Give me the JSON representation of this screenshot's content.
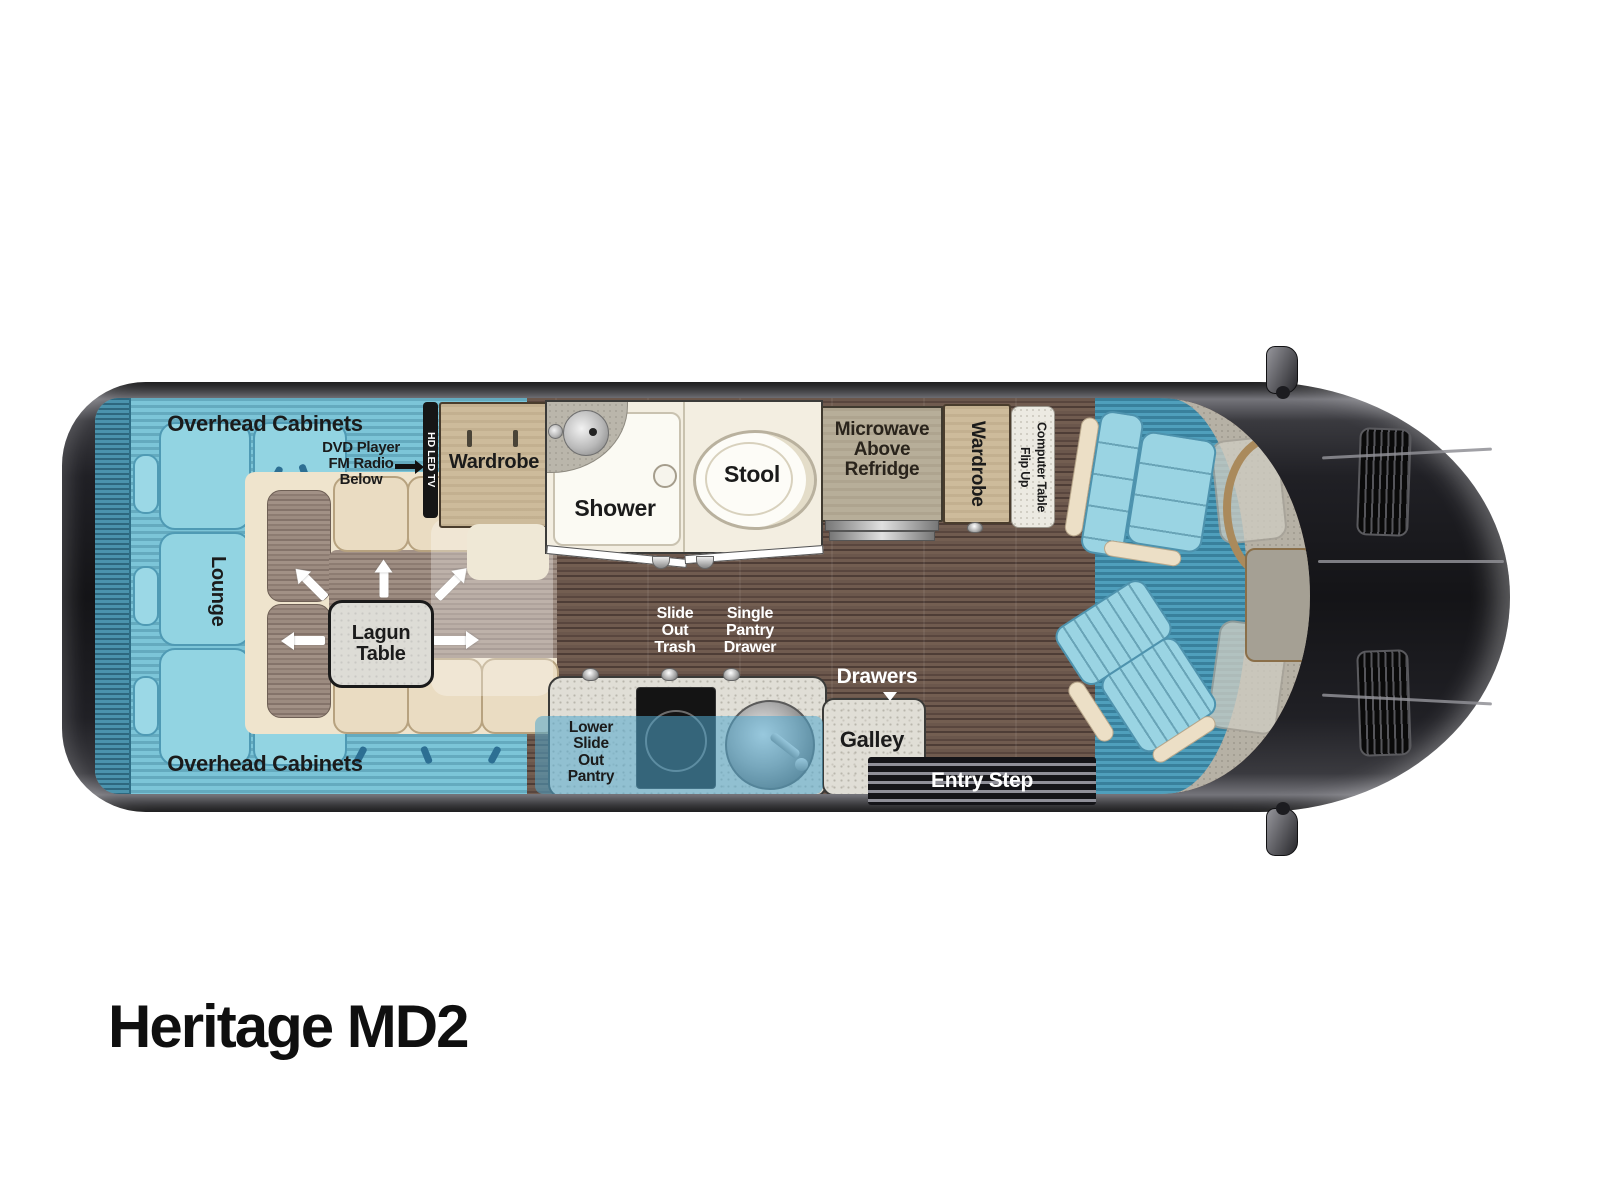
{
  "title": "Heritage MD2",
  "labels": {
    "overhead_cabinets_top": "Overhead Cabinets",
    "overhead_cabinets_bottom": "Overhead Cabinets",
    "lounge": "Lounge",
    "dvd_player": "DVD Player\nFM Radio\nBelow",
    "hd_led_tv": "HD LED TV",
    "wardrobe_rear": "Wardrobe",
    "shower": "Shower",
    "stool": "Stool",
    "microwave": "Microwave\nAbove\nRefridge",
    "wardrobe_front": "Wardrobe",
    "flip_up_computer_table": "Flip Up\nComputer Table",
    "lagun_table": "Lagun\nTable",
    "slide_out_trash": "Slide\nOut\nTrash",
    "single_pantry_drawer": "Single\nPantry\nDrawer",
    "drawers": "Drawers",
    "lower_slide_out_pantry": "Lower\nSlide\nOut\nPantry",
    "galley": "Galley",
    "entry_step": "Entry Step"
  },
  "colors": {
    "lounge_blue": "#7cc5d8",
    "cushion_blue": "#92d4e2",
    "carpet_blue": "#4f9fbc",
    "seat_tan": "#cdbb9b",
    "cream": "#f3eee1",
    "cabinet_khaki": "#b7ae99",
    "wood_floor": "#635046",
    "counter_gray": "#e0ded6",
    "body_dark": "#1c1c20",
    "slideout_overlay": "#50a8cd"
  }
}
